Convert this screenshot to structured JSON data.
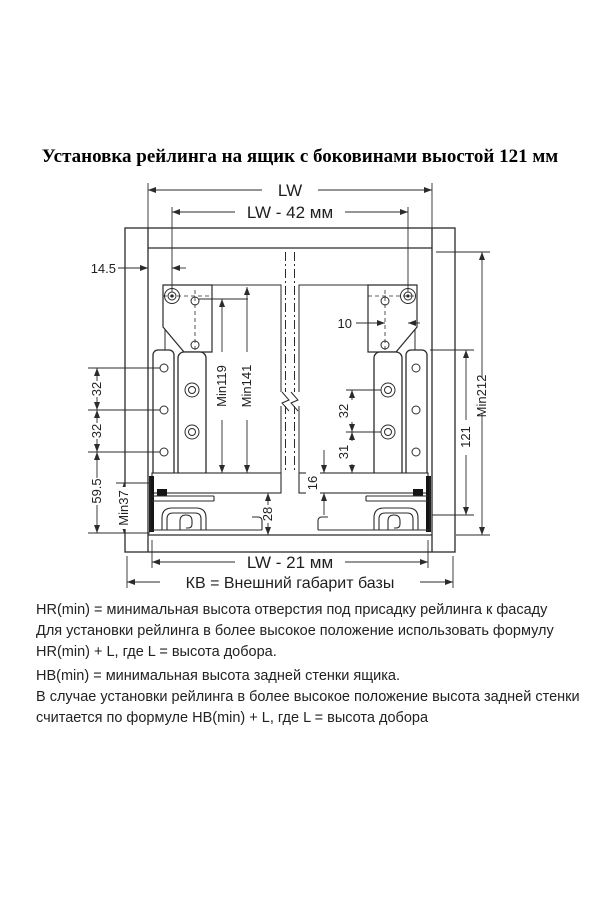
{
  "title": "Установка рейлинга на ящик с боковинами выостой 121 мм",
  "dims": {
    "lw": "LW",
    "lw_minus_42": "LW - 42 мм",
    "lw_minus_21": "LW -  21 мм",
    "kv": "КВ = Внешний габарит базы",
    "offset_145": "14.5",
    "offset_10": "10",
    "min119": "Min119",
    "min141": "Min141",
    "min212": "Min212",
    "h121": "121",
    "p32a": "32",
    "p32b": "32",
    "d595": "59.5",
    "min37": "Min37",
    "r32": "32",
    "r31": "31",
    "t16": "16",
    "c28": "28"
  },
  "notes": {
    "hr": [
      "HR(min) = минимальная высота отверстия под присадку рейлинга к фасаду",
      "Для установки рейлинга в более высокое положение использовать формулу",
      "HR(min) + L,  где L = высота добора."
    ],
    "hb": [
      "HB(min) = минимальная высота задней стенки ящика.",
      "В случае установки рейлинга в более высокое положение высота задней стенки",
      "считается по формуле HB(min) + L, где L = высота добора"
    ]
  },
  "colors": {
    "line": "#2b2b2b",
    "text": "#1f1f1f",
    "background": "#ffffff"
  }
}
